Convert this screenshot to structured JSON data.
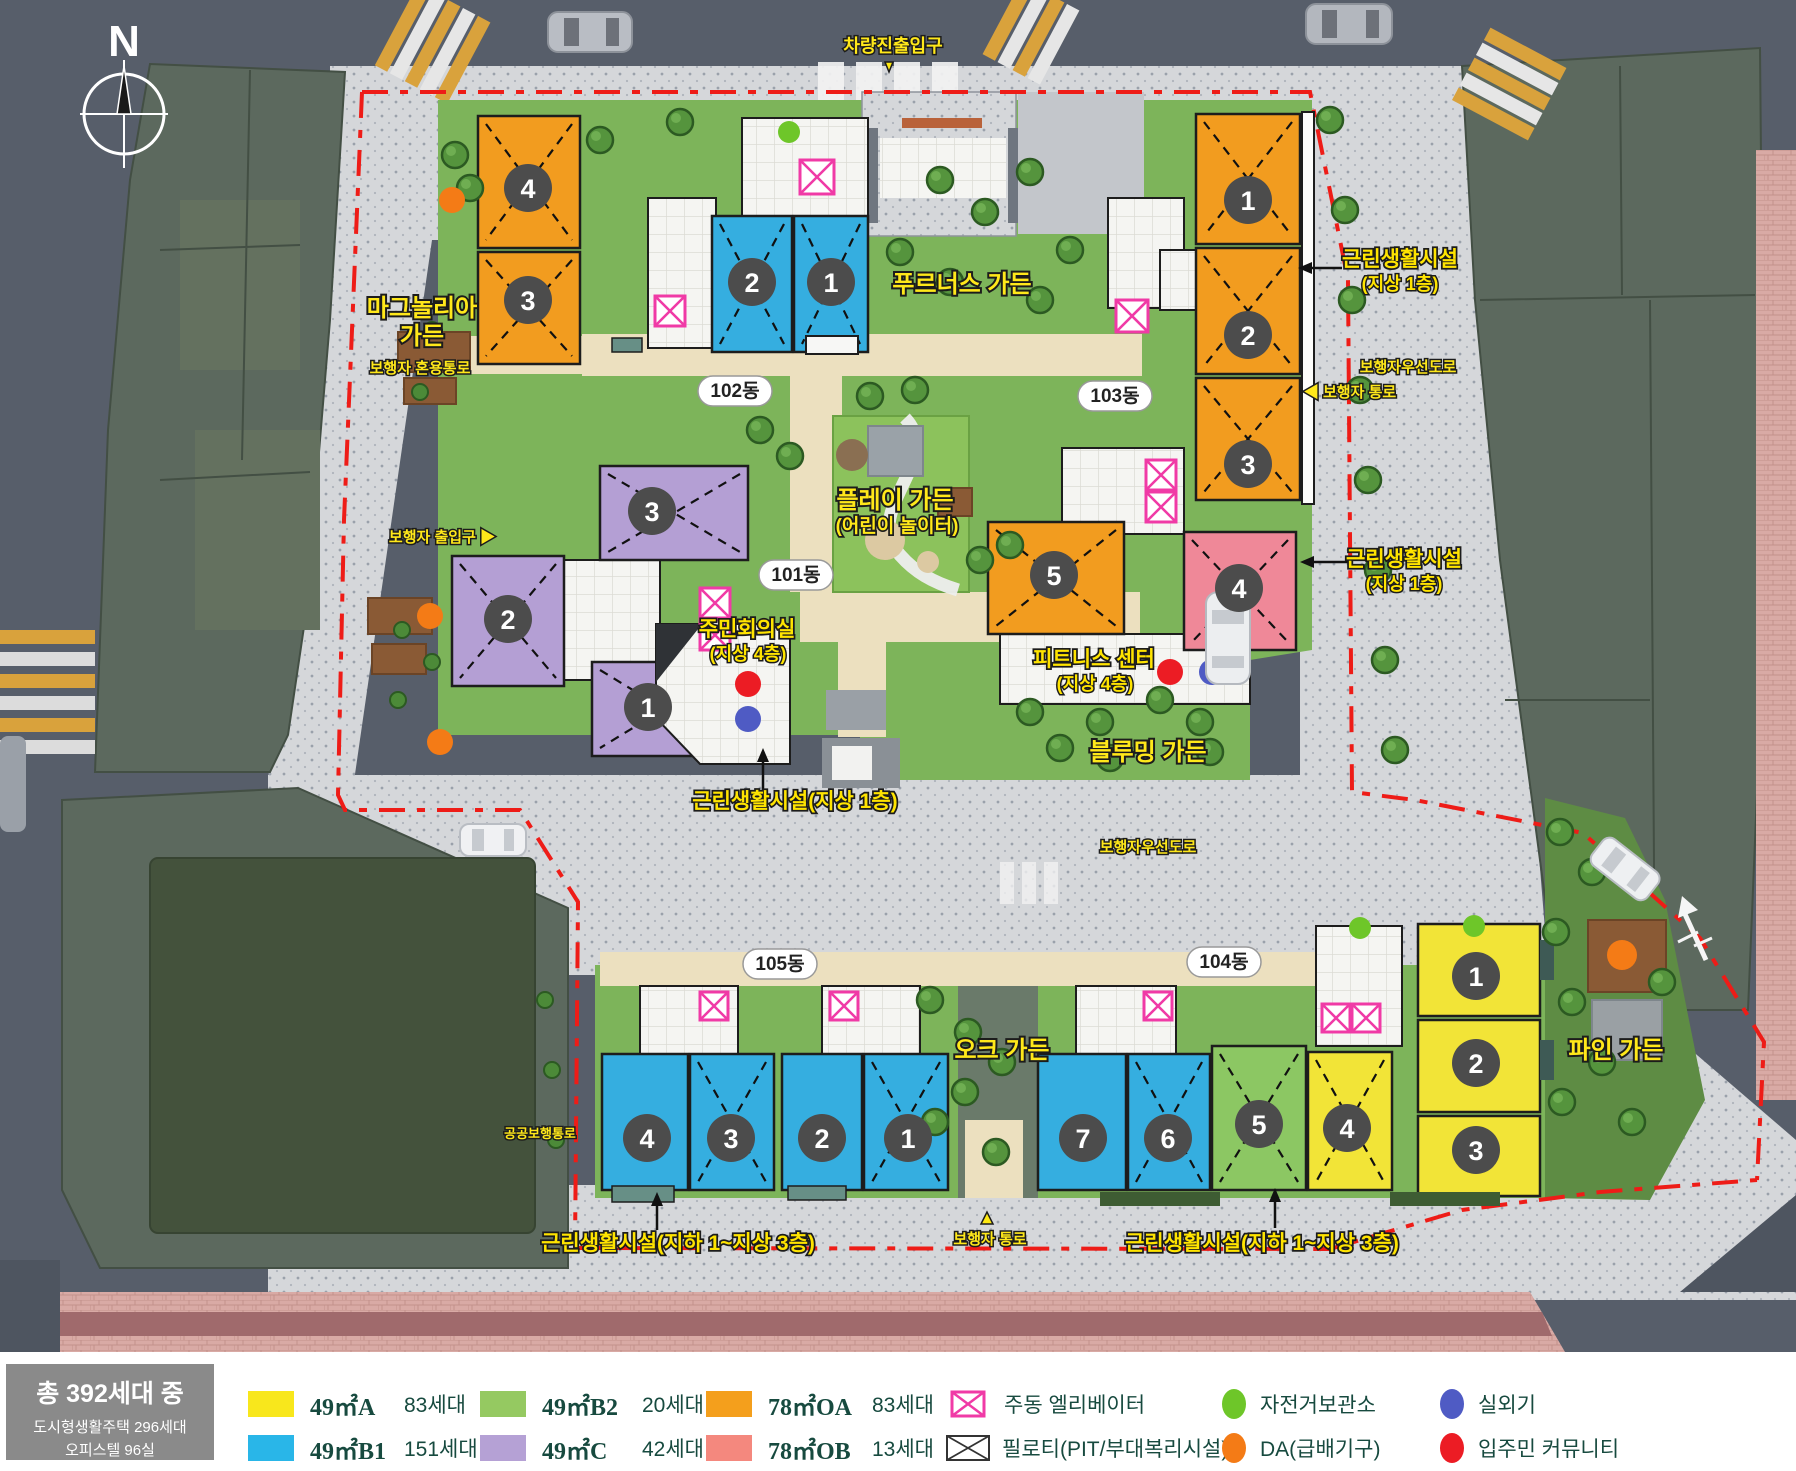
{
  "plan": {
    "compass": "N",
    "badges": [
      "102동",
      "103동",
      "101동",
      "105동",
      "104동"
    ],
    "gardens": {
      "magnolia": [
        "마그놀리아",
        "가든"
      ],
      "prunus": [
        "푸르너스 가든"
      ],
      "play": [
        "플레이 가든",
        "(어린이 놀이터)"
      ],
      "blooming": [
        "블루밍 가든"
      ],
      "oak": [
        "오크 가든"
      ],
      "pine": [
        "파인 가든"
      ]
    },
    "facilities": {
      "community": [
        "주민회의실",
        "(지상 4층)"
      ],
      "fitness": [
        "피트니스 센터",
        "(지상 4층)"
      ],
      "retail_top_right": [
        "근린생활시설",
        "(지상 1층)"
      ],
      "retail_mid_right": [
        "근린생활시설",
        "(지상 1층)"
      ],
      "retail_center": "근린생활시설(지상 1층)",
      "retail_bottom_left": "근린생활시설(지하 1~지상 3층)",
      "retail_bottom_right": "근린생활시설(지하 1~지상 3층)"
    },
    "roads": {
      "vehicle_entrance": "차량진출입구",
      "ped_mixed": "보행자 혼용통로",
      "ped_gate": "보행자 출입구 ▶",
      "ped_priority_right": "보행자우선도로",
      "ped_path_right": "◀ 보행자 통로",
      "ped_priority_bottom": "보행자우선도로",
      "ped_path_bottom": "보행자 통로",
      "public_walk": "공공보행통로"
    },
    "buildings": [
      {
        "dong": "102동",
        "no": "4",
        "type": "78㎡OA"
      },
      {
        "dong": "102동",
        "no": "3",
        "type": "78㎡OA"
      },
      {
        "dong": "102동",
        "no": "2",
        "type": "49㎡B1"
      },
      {
        "dong": "102동",
        "no": "1",
        "type": "49㎡B1"
      },
      {
        "dong": "103동",
        "no": "1",
        "type": "78㎡OA"
      },
      {
        "dong": "103동",
        "no": "2",
        "type": "78㎡OA"
      },
      {
        "dong": "103동",
        "no": "3",
        "type": "78㎡OA"
      },
      {
        "dong": "101동",
        "no": "3",
        "type": "49㎡C"
      },
      {
        "dong": "101동",
        "no": "2",
        "type": "49㎡C"
      },
      {
        "dong": "101동",
        "no": "1",
        "type": "49㎡C"
      },
      {
        "dong": "103동",
        "no": "5",
        "type": "78㎡OA"
      },
      {
        "dong": "103동",
        "no": "4",
        "type": "78㎡OB"
      },
      {
        "dong": "105동",
        "no": "4",
        "type": "49㎡B1"
      },
      {
        "dong": "105동",
        "no": "3",
        "type": "49㎡B1"
      },
      {
        "dong": "105동",
        "no": "2",
        "type": "49㎡B1"
      },
      {
        "dong": "105동",
        "no": "1",
        "type": "49㎡B1"
      },
      {
        "dong": "104동",
        "no": "7",
        "type": "49㎡B1"
      },
      {
        "dong": "104동",
        "no": "6",
        "type": "49㎡B1"
      },
      {
        "dong": "104동",
        "no": "5",
        "type": "49㎡B2"
      },
      {
        "dong": "104동",
        "no": "4",
        "type": "49㎡A"
      },
      {
        "dong": "104동",
        "no": "1",
        "type": "49㎡A"
      },
      {
        "dong": "104동",
        "no": "2",
        "type": "49㎡A"
      },
      {
        "dong": "104동",
        "no": "3",
        "type": "49㎡A"
      }
    ],
    "boundary_color": "#ee1c17"
  },
  "legend": {
    "summary": {
      "title": "총 392세대 중",
      "line1": "도시형생활주택 296세대",
      "line2": "오피스텔 96실"
    },
    "types": [
      {
        "label": "49㎡A",
        "count": "83세대",
        "color": "#f8e71c"
      },
      {
        "label": "49㎡B1",
        "count": "151세대",
        "color": "#29b6e8"
      },
      {
        "label": "49㎡B2",
        "count": "20세대",
        "color": "#95c961"
      },
      {
        "label": "49㎡C",
        "count": "42세대",
        "color": "#b5a1d5"
      },
      {
        "label": "78㎡OA",
        "count": "83세대",
        "color": "#f49f1c"
      },
      {
        "label": "78㎡OB",
        "count": "13세대",
        "color": "#f4887e"
      }
    ],
    "symbols": [
      {
        "name": "elevator",
        "label": "주동 엘리베이터",
        "color": "#f03aa6"
      },
      {
        "name": "piloti",
        "label": "필로티(PIT/부대복리시설)",
        "color": "#333333"
      },
      {
        "name": "bicycle",
        "label": "자전거보관소",
        "color": "#6ec629"
      },
      {
        "name": "da",
        "label": "DA(급배기구)",
        "color": "#f47b16"
      },
      {
        "name": "outdoor-unit",
        "label": "실외기",
        "color": "#4f5bc4"
      },
      {
        "name": "community",
        "label": "입주민 커뮤니티",
        "color": "#ec1c24"
      }
    ]
  }
}
